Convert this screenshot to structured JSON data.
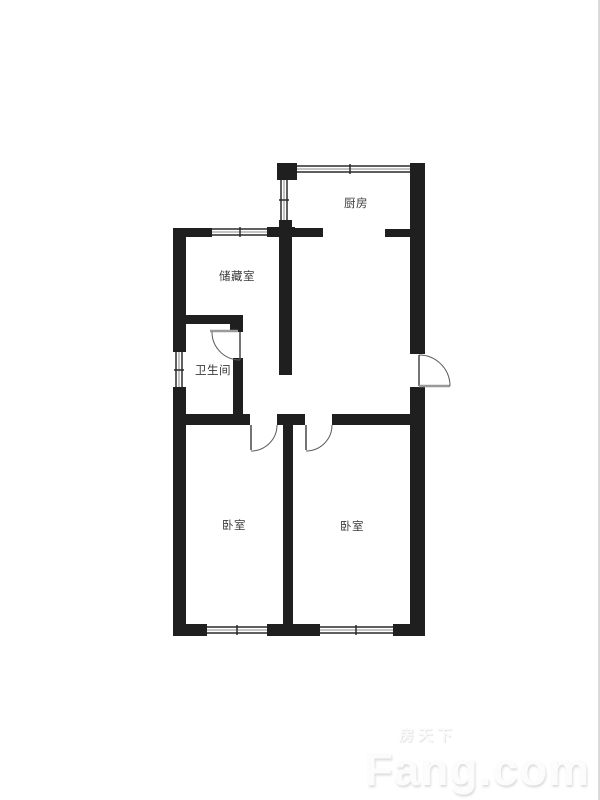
{
  "floor_plan": {
    "wall_color": "#1f1f1f",
    "rooms": [
      {
        "id": "kitchen",
        "label": "厨房"
      },
      {
        "id": "storage",
        "label": "储藏室"
      },
      {
        "id": "bathroom",
        "label": "卫生间"
      },
      {
        "id": "bedroom-left",
        "label": "卧室"
      },
      {
        "id": "bedroom-right",
        "label": "卧室"
      }
    ]
  },
  "watermark": {
    "cn": "房天下",
    "en": "Fang.com"
  }
}
